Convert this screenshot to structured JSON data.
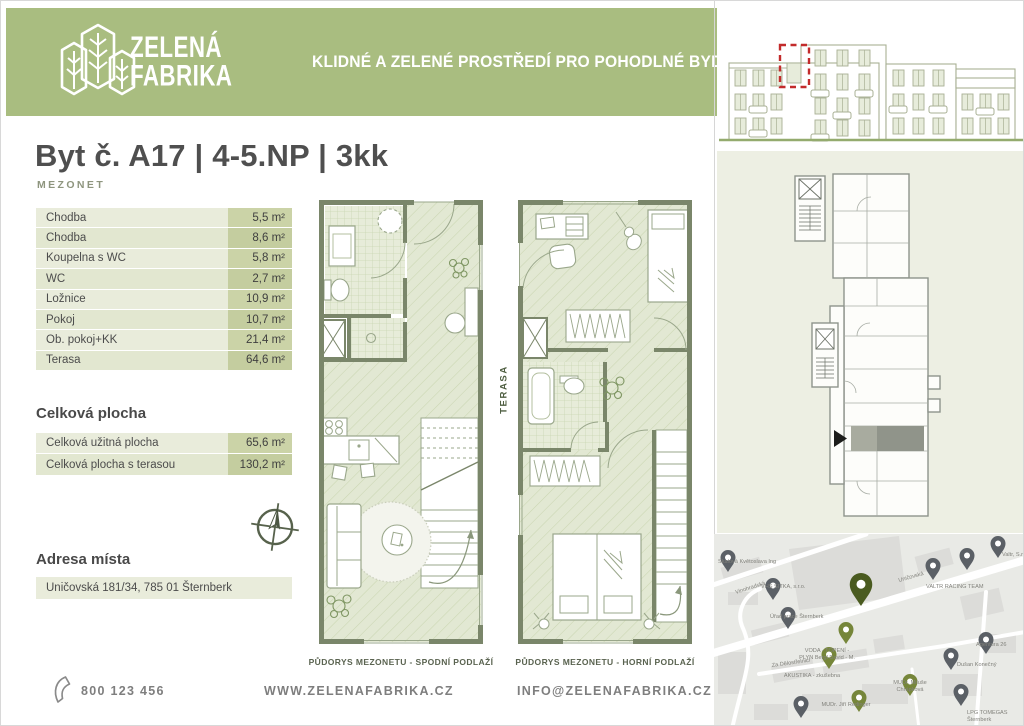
{
  "brand": {
    "name_line1": "ZELENÁ",
    "name_line2": "FABRIKA",
    "tagline": "KLIDNÉ A ZELENÉ PROSTŘEDÍ PRO POHODLNÉ BYDLENÍ"
  },
  "listing": {
    "title": "Byt č. A17 | 4-5.NP | 3kk",
    "subtitle": "MEZONET"
  },
  "rooms": {
    "rows": [
      {
        "label": "Chodba",
        "area": "5,5 m²"
      },
      {
        "label": "Chodba",
        "area": "8,6 m²"
      },
      {
        "label": "Koupelna s WC",
        "area": "5,8 m²"
      },
      {
        "label": "WC",
        "area": "2,7 m²"
      },
      {
        "label": "Ložnice",
        "area": "10,9 m²"
      },
      {
        "label": "Pokoj",
        "area": "10,7 m²"
      },
      {
        "label": "Ob. pokoj+KK",
        "area": "21,4 m²"
      },
      {
        "label": "Terasa",
        "area": "64,6 m²"
      }
    ]
  },
  "totals": {
    "heading": "Celková plocha",
    "rows": [
      {
        "label": "Celková užitná plocha",
        "area": "65,6 m²"
      },
      {
        "label": "Celková plocha s terasou",
        "area": "130,2 m²"
      }
    ]
  },
  "address": {
    "heading": "Adresa místa",
    "value": "Uničovská 181/34, 785 01 Šternberk"
  },
  "plans": {
    "lower_caption": "PŮDORYS MEZONETU - SPODNÍ PODLAŽÍ",
    "upper_caption": "PŮDORYS MEZONETU - HORNÍ PODLAŽÍ",
    "terrace_label": "TERASA"
  },
  "footer": {
    "phone": "800 123 456",
    "website": "WWW.ZELENAFABRIKA.CZ",
    "email": "INFO@ZELENAFABRIKA.CZ"
  },
  "map": {
    "labels": [
      "Skalová Květoslava Ing",
      "VHS SITKA, s.r.o.",
      "Úřad práce Šternberk",
      "VODA - TOPENÍ -",
      "PLYN Bergl David - M.",
      "AKUSTIKA - zkušebna",
      "VALTR RACING TEAM",
      "Valtr, S.r.",
      "Agentura 26",
      "Dušan Konečný",
      "MUDr. Miluše",
      "Chrápková",
      "LPG TOMEGAS",
      "Šternberk",
      "MUDr. Jiří Redinger",
      "Vinohradská",
      "Uničovská",
      "Za Dělostřelnicí"
    ]
  },
  "colors": {
    "header_green": "#a9bd80",
    "table_label_bg": "#e9ecdb",
    "table_value_bg": "#cbd3a7",
    "highlight_red": "#c32b2b",
    "plan_wall": "#7a866a",
    "siteplan_bg": "#edefe3"
  }
}
